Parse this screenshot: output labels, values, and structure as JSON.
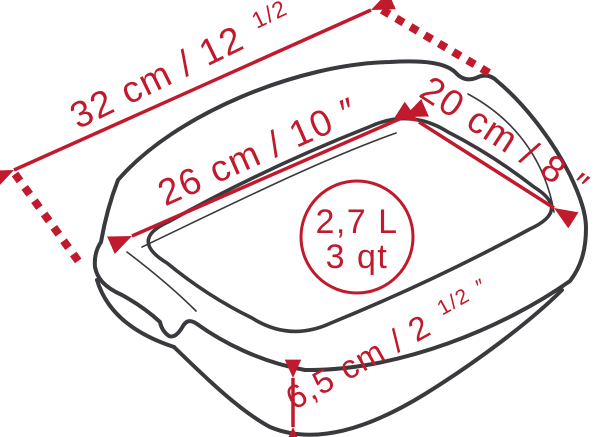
{
  "colors": {
    "outline": "#3a3a3e",
    "accent_red": "#c01a2c",
    "background": "#ffffff"
  },
  "dimensions": {
    "outer_length": {
      "main": "32 cm / 12",
      "frac": "1/2",
      "unit": "″"
    },
    "inner_length": {
      "main": "26 cm / 10",
      "unit": "″"
    },
    "inner_width": {
      "main": "20 cm / 8",
      "unit": "″"
    },
    "height": {
      "main": "6,5 cm / 2",
      "frac": "1/2",
      "unit": "″"
    }
  },
  "capacity": {
    "volume_liters": "2,7 L",
    "volume_quarts": "3 qt"
  }
}
